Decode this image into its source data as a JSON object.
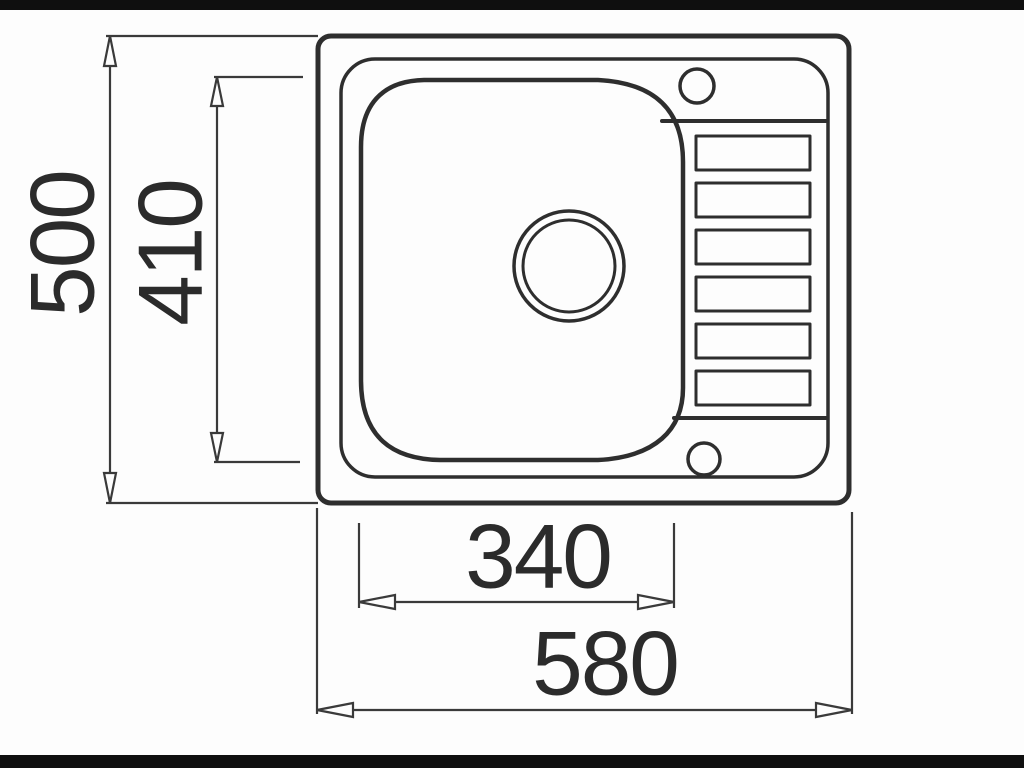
{
  "drawing": {
    "subject": "kitchen-sink-top-view-technical-drawing",
    "line_color": "#2e2e2e",
    "dim_line_color": "#3a3a3a",
    "text_color": "#2b2b2b",
    "background_color": "#fdfdfd",
    "letterbox_color": "#0f0f0f",
    "dimensions": {
      "overall_depth": "500",
      "bowl_depth": "410",
      "bowl_width": "340",
      "overall_width": "580"
    },
    "features": {
      "drainer_ridge_count": 6,
      "tap_hole_count": 2,
      "bowl_count": 1
    }
  }
}
